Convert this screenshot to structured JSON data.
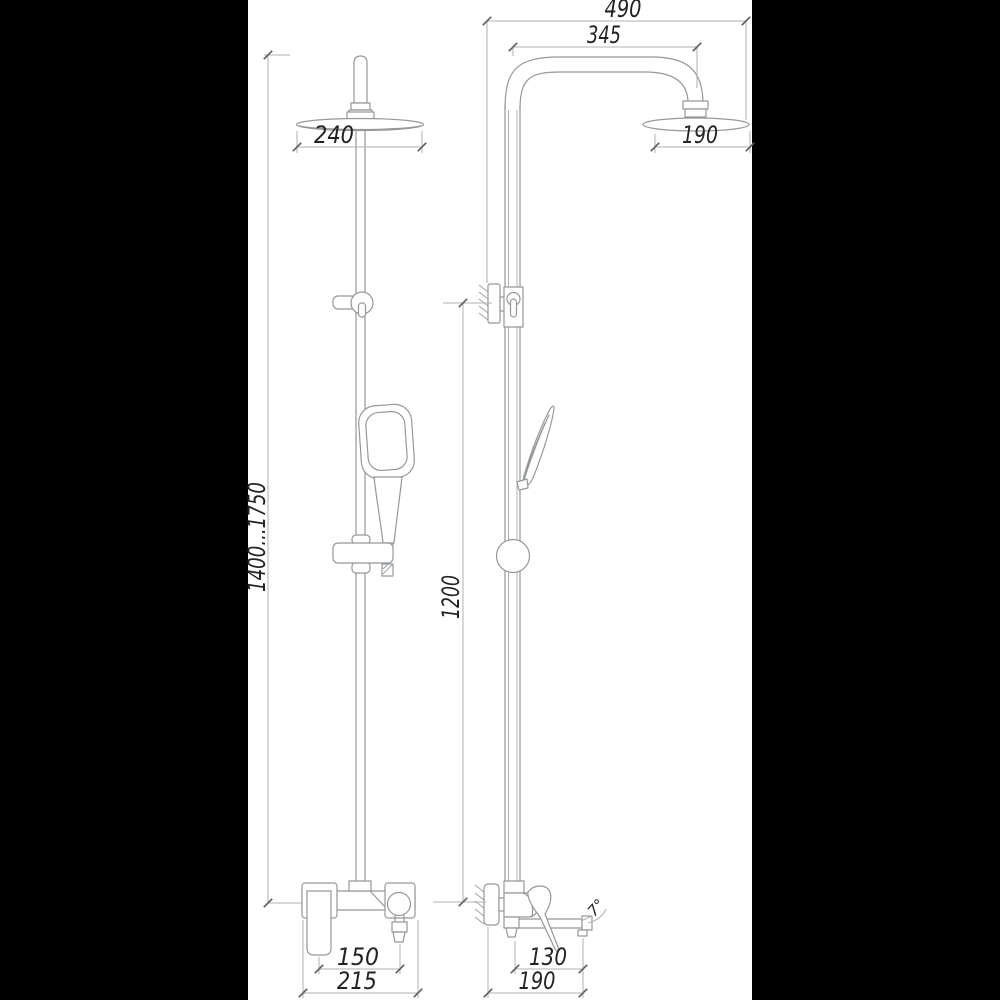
{
  "drawing": {
    "kind": "technical-dimension-diagram",
    "subject": "shower column with rain head, hand shower and wall mixer (front and side views)",
    "colors": {
      "background": "#000000",
      "paper": "#ffffff",
      "line": "#94989b",
      "text": "#232323"
    }
  },
  "dims": {
    "front": {
      "head_diameter": "240",
      "height_range": "1400...1750",
      "outlet_spacing": "150",
      "overall_width": "215"
    },
    "side": {
      "overall_reach": "490",
      "arm_reach": "345",
      "head_depth": "190",
      "column_height": "1200",
      "spout_reach": "130",
      "overall_depth": "190",
      "spout_angle": "7°"
    }
  }
}
